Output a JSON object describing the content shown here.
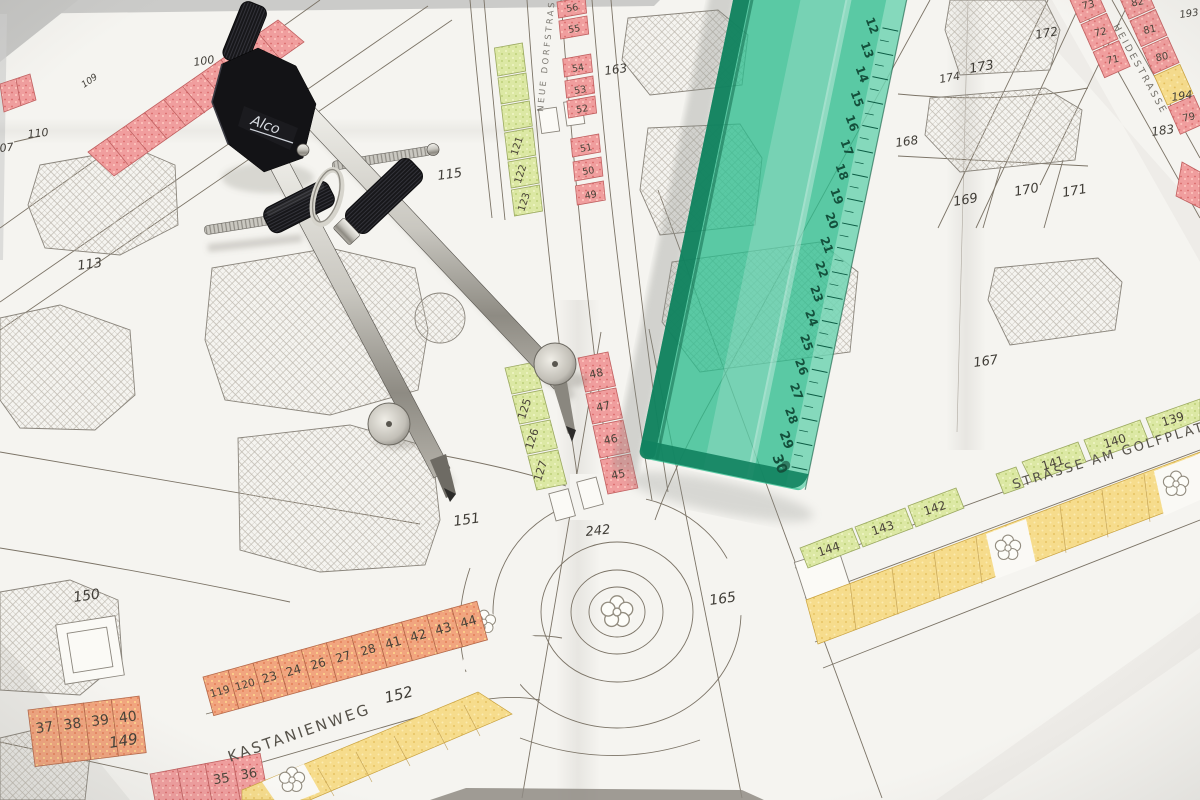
{
  "map": {
    "streets": {
      "kastanienweg": "KASTANIENWEG",
      "golfplatz": "STRASSE AM GOLFPLATZ",
      "heidestrasse": "HEIDESTRASSE",
      "dorfstrasse": "NEUE DORFSTRASSE"
    },
    "parcels": {
      "p07": "07",
      "p100": "100",
      "p109": "109",
      "p110": "110",
      "p113": "113",
      "p115": "115",
      "p149": "149",
      "p150": "150",
      "p151": "151",
      "p152": "152",
      "p163": "163",
      "p165": "165",
      "p167": "167",
      "p168": "168",
      "p169": "169",
      "p170": "170",
      "p171": "171",
      "p172": "172",
      "p173": "173",
      "p174": "174",
      "p183": "183",
      "p193": "193",
      "p194": "194",
      "p242": "242"
    },
    "lots": {
      "north_red": [
        "56",
        "55",
        "54",
        "53",
        "52",
        "51",
        "50",
        "49"
      ],
      "south_red": [
        "48",
        "47",
        "46",
        "45"
      ],
      "north_green": [
        "121",
        "122",
        "123"
      ],
      "south_green": [
        "125",
        "126",
        "127"
      ],
      "golf_east": [
        "141",
        "140",
        "139"
      ],
      "golf_west": [
        "144",
        "143",
        "142"
      ],
      "kastanien": [
        "119",
        "120",
        "23",
        "24",
        "26",
        "27",
        "28",
        "41",
        "42",
        "43",
        "44"
      ],
      "west_block": [
        "37",
        "38",
        "39",
        "40"
      ],
      "south_block": [
        "35",
        "36"
      ],
      "heide_west": [
        "73",
        "72",
        "71"
      ],
      "heide_east": [
        "83",
        "82",
        "81",
        "80",
        "79"
      ]
    },
    "colors": {
      "lot_red": "#f09e9e",
      "lot_orange": "#f1a57f",
      "lot_green": "#dce8a4",
      "lot_yellow": "#f6dc8c"
    }
  },
  "ruler": {
    "color": "#2ebd8e",
    "numbers": [
      "12",
      "13",
      "14",
      "15",
      "16",
      "17",
      "18",
      "19",
      "20",
      "21",
      "22",
      "23",
      "24",
      "25",
      "26",
      "27",
      "28",
      "29",
      "30"
    ]
  },
  "compass": {
    "brand": "Alco"
  }
}
